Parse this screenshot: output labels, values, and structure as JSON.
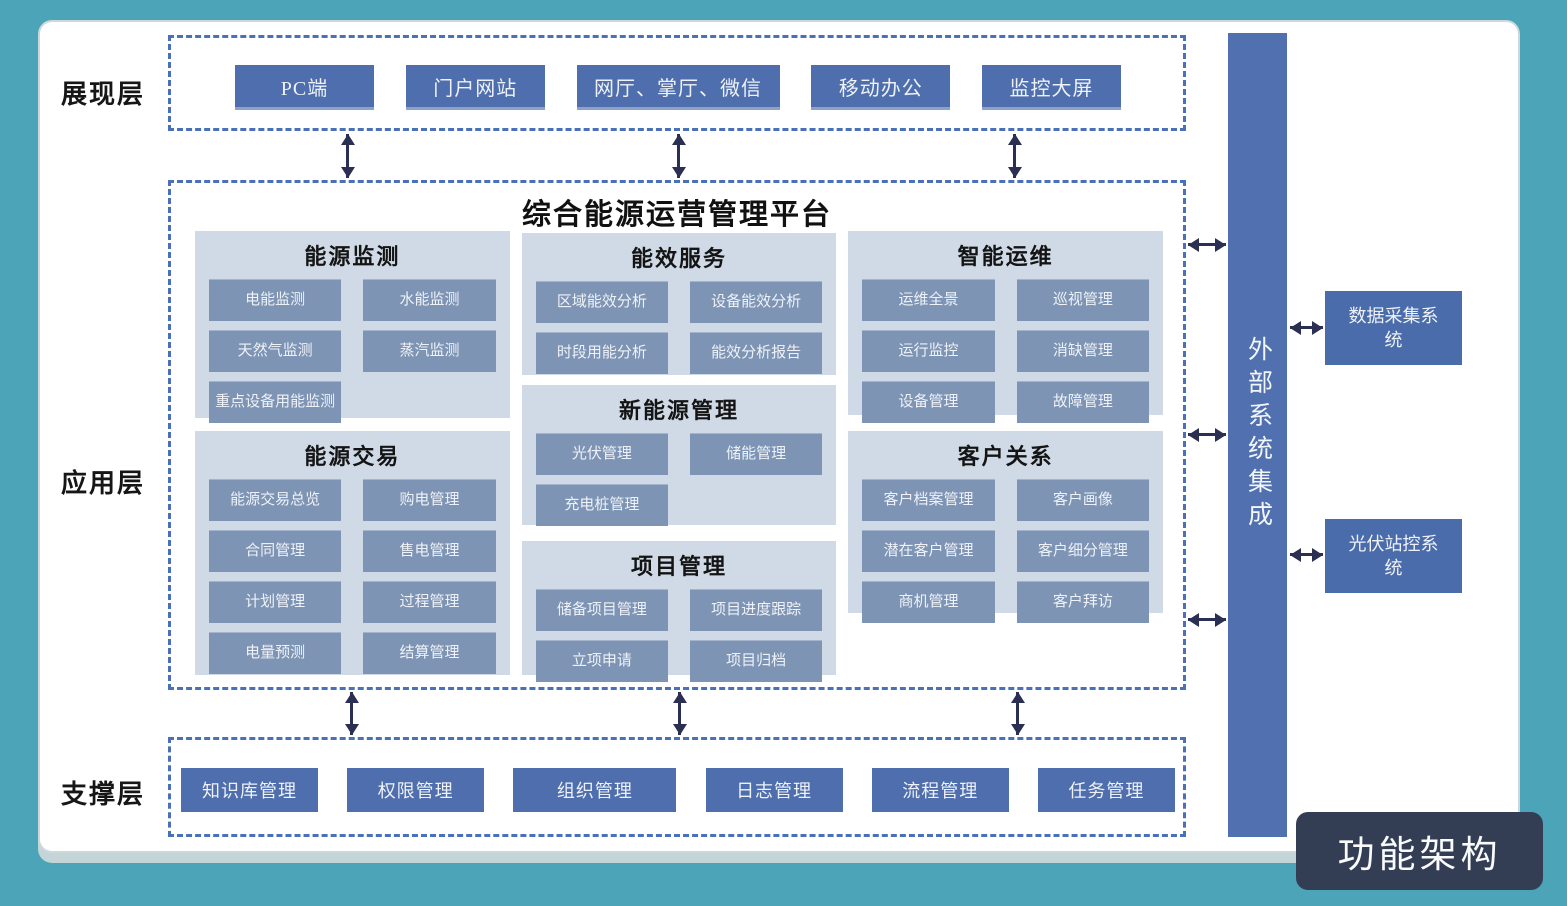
{
  "page": {
    "badge": "功能架构"
  },
  "layers": {
    "presentation": {
      "label": "展现层",
      "items": [
        "PC端",
        "门户网站",
        "网厅、掌厅、微信",
        "移动办公",
        "监控大屏"
      ]
    },
    "application": {
      "label": "应用层",
      "title": "综合能源运营管理平台",
      "groups": [
        {
          "title": "能源监测",
          "items": [
            "电能监测",
            "水能监测",
            "天然气监测",
            "蒸汽监测",
            "重点设备用能监测"
          ]
        },
        {
          "title": "能源交易",
          "items": [
            "能源交易总览",
            "购电管理",
            "合同管理",
            "售电管理",
            "计划管理",
            "过程管理",
            "电量预测",
            "结算管理"
          ]
        },
        {
          "title": "能效服务",
          "items": [
            "区域能效分析",
            "设备能效分析",
            "时段用能分析",
            "能效分析报告"
          ]
        },
        {
          "title": "新能源管理",
          "items": [
            "光伏管理",
            "储能管理",
            "充电桩管理"
          ]
        },
        {
          "title": "项目管理",
          "items": [
            "储备项目管理",
            "项目进度跟踪",
            "立项申请",
            "项目归档"
          ]
        },
        {
          "title": "智能运维",
          "items": [
            "运维全景",
            "巡视管理",
            "运行监控",
            "消缺管理",
            "设备管理",
            "故障管理"
          ]
        },
        {
          "title": "客户关系",
          "items": [
            "客户档案管理",
            "客户画像",
            "潜在客户管理",
            "客户细分管理",
            "商机管理",
            "客户拜访"
          ]
        }
      ]
    },
    "support": {
      "label": "支撑层",
      "items": [
        "知识库管理",
        "权限管理",
        "组织管理",
        "日志管理",
        "流程管理",
        "任务管理"
      ]
    }
  },
  "external": {
    "bar_label": "外部系统集成",
    "systems": [
      "数据采集系统",
      "光伏站控系统"
    ]
  },
  "colors": {
    "background_teal": "#4ba4b8",
    "dashed_border_blue": "#4a70b8",
    "solid_box_blue": "#4f6ead",
    "panel_light_blue": "#cfdae6",
    "item_gray_blue": "#7e94b4",
    "arrow_navy": "#2b3053",
    "badge_dark": "#333e54"
  }
}
